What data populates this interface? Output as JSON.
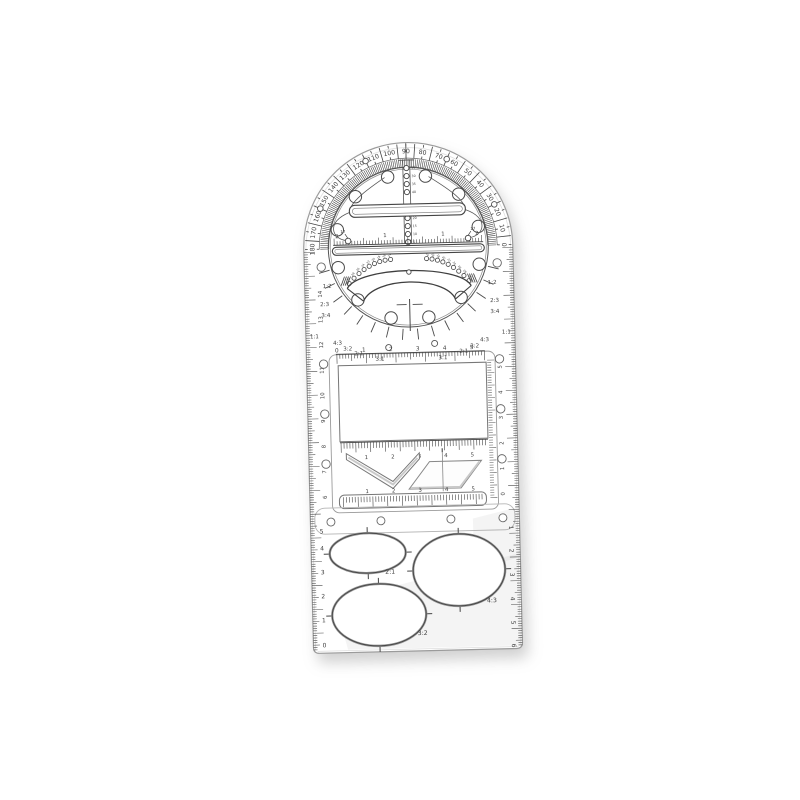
{
  "scene": {
    "background": "#ffffff",
    "object": "transparent multifunctional geometric drawing template ruler"
  },
  "colors": {
    "line": "#3f3f3f",
    "mid_line": "#6e6e6e",
    "edge": "#9b9b9b",
    "faint": "#dedede",
    "shade": "rgba(150,150,150,0.10)"
  },
  "protractor": {
    "degree_labels": [
      "0",
      "10",
      "20",
      "30",
      "40",
      "50",
      "60",
      "70",
      "80",
      "90",
      "100",
      "110",
      "120",
      "130",
      "140",
      "150",
      "160",
      "170",
      "180"
    ]
  },
  "disc": {
    "bar_numbers": [
      "2",
      "1",
      "1",
      "2"
    ],
    "bar_hole_labels": [
      "17",
      "17"
    ],
    "column_hole_labels_upper": [
      "25",
      "30",
      "35",
      "40"
    ],
    "column_hole_labels_lower": [
      "20",
      "15",
      "10",
      "5"
    ],
    "arc_hole_labels": [
      "14",
      "16",
      "18",
      "20",
      "22",
      "24",
      "26",
      "28",
      "30"
    ],
    "ratio_labels_left": [
      "1:2",
      "2:3",
      "3:4",
      "1:1",
      "4:3",
      "3:2",
      "2:1",
      "3:1"
    ],
    "ratio_labels_right": [
      "1:2",
      "2:3",
      "3:4",
      "1:1",
      "4:3",
      "3:2",
      "2:1",
      "3:1"
    ]
  },
  "middle": {
    "top_ruler_labels": [
      "0",
      "1",
      "2",
      "3",
      "4",
      "5"
    ],
    "mid_ruler_labels": [
      "1",
      "2",
      "3",
      "4",
      "5"
    ],
    "bottom_ruler_labels": [
      "1",
      "2",
      "3",
      "4",
      "5"
    ],
    "left_scale_labels": [
      "14",
      "13",
      "12",
      "11",
      "10",
      "9",
      "8",
      "7",
      "6"
    ],
    "right_scale_labels": [
      "5",
      "4",
      "3",
      "2",
      "1",
      "0"
    ]
  },
  "bottom": {
    "ellipses": [
      {
        "label": "2:1"
      },
      {
        "label": "4:3"
      },
      {
        "label": "3:2"
      }
    ],
    "left_scale_labels": [
      "5",
      "4",
      "3",
      "2",
      "1",
      "0"
    ],
    "right_scale_labels": [
      "1",
      "2",
      "3",
      "4",
      "5",
      "6"
    ]
  }
}
